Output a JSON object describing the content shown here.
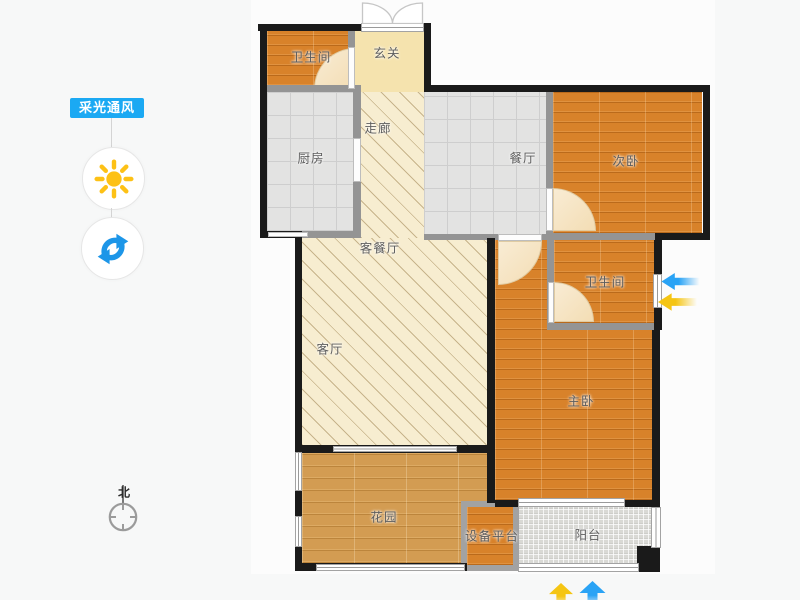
{
  "sidebar": {
    "tool_label": "采光通风",
    "buttons": [
      {
        "name": "daylight",
        "icon": "sun-icon"
      },
      {
        "name": "rotate",
        "icon": "rotate-icon"
      }
    ],
    "compass": {
      "label": "北",
      "icon": "compass-icon"
    }
  },
  "rooms": {
    "bath1": {
      "label": "卫生间"
    },
    "entry": {
      "label": "玄关"
    },
    "kitchen": {
      "label": "厨房"
    },
    "corridor": {
      "label": "走廊"
    },
    "dining": {
      "label": "餐厅"
    },
    "bed2": {
      "label": "次卧"
    },
    "living_dining": {
      "label": "客餐厅"
    },
    "living": {
      "label": "客厅"
    },
    "bath2": {
      "label": "卫生间"
    },
    "master": {
      "label": "主卧"
    },
    "garden": {
      "label": "花园"
    },
    "equipment": {
      "label": "设备平台"
    },
    "balcony": {
      "label": "阳台"
    }
  },
  "colors": {
    "tool_bg": "#1ba9f3",
    "sun": "#fdc116",
    "rotate": "#1d96e8",
    "arrow_blue": "#2aa3f5",
    "arrow_yellow": "#f5c513"
  }
}
